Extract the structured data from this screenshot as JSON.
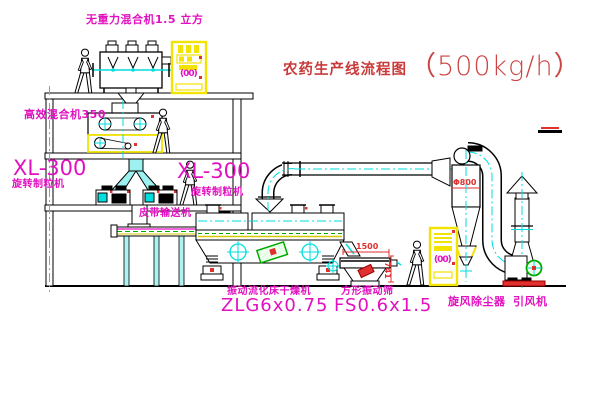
{
  "title": {
    "zh": "农药生产线流程图",
    "capacity": "（500kg/h）"
  },
  "labels": {
    "gravity_mixer": "无重力混合机1.5 立方",
    "high_eff_mixer": "高效混合机350",
    "granulator_left_model": "XL-300",
    "granulator_left_name": "旋转制粒机",
    "granulator_mid_model": "XL-300",
    "granulator_mid_name": "旋转制粒机",
    "belt_conveyor": "皮带输送机",
    "dryer_name": "振动流化床干燥机",
    "dryer_model": "ZLG6x0.75",
    "sieve_name": "方形振动筛",
    "sieve_model": "FS0.6x1.5",
    "cyclone": "旋风除尘器",
    "fan": "引风机"
  },
  "dimensions": {
    "sieve_length": "1500",
    "sieve_height": "741",
    "cyclone_diameter": "Φ800"
  },
  "cabinets": {
    "cabinet1_label": "(00)",
    "cabinet2_label": "(00)"
  },
  "colors": {
    "line": "#000000",
    "centerline_cyan": "#00dede",
    "equipment_yellow": "#f2e300",
    "label_magenta": "#e211c0",
    "dim_red": "#e03030",
    "title_red": "#c93a3a",
    "accent_green": "#00aa00"
  }
}
